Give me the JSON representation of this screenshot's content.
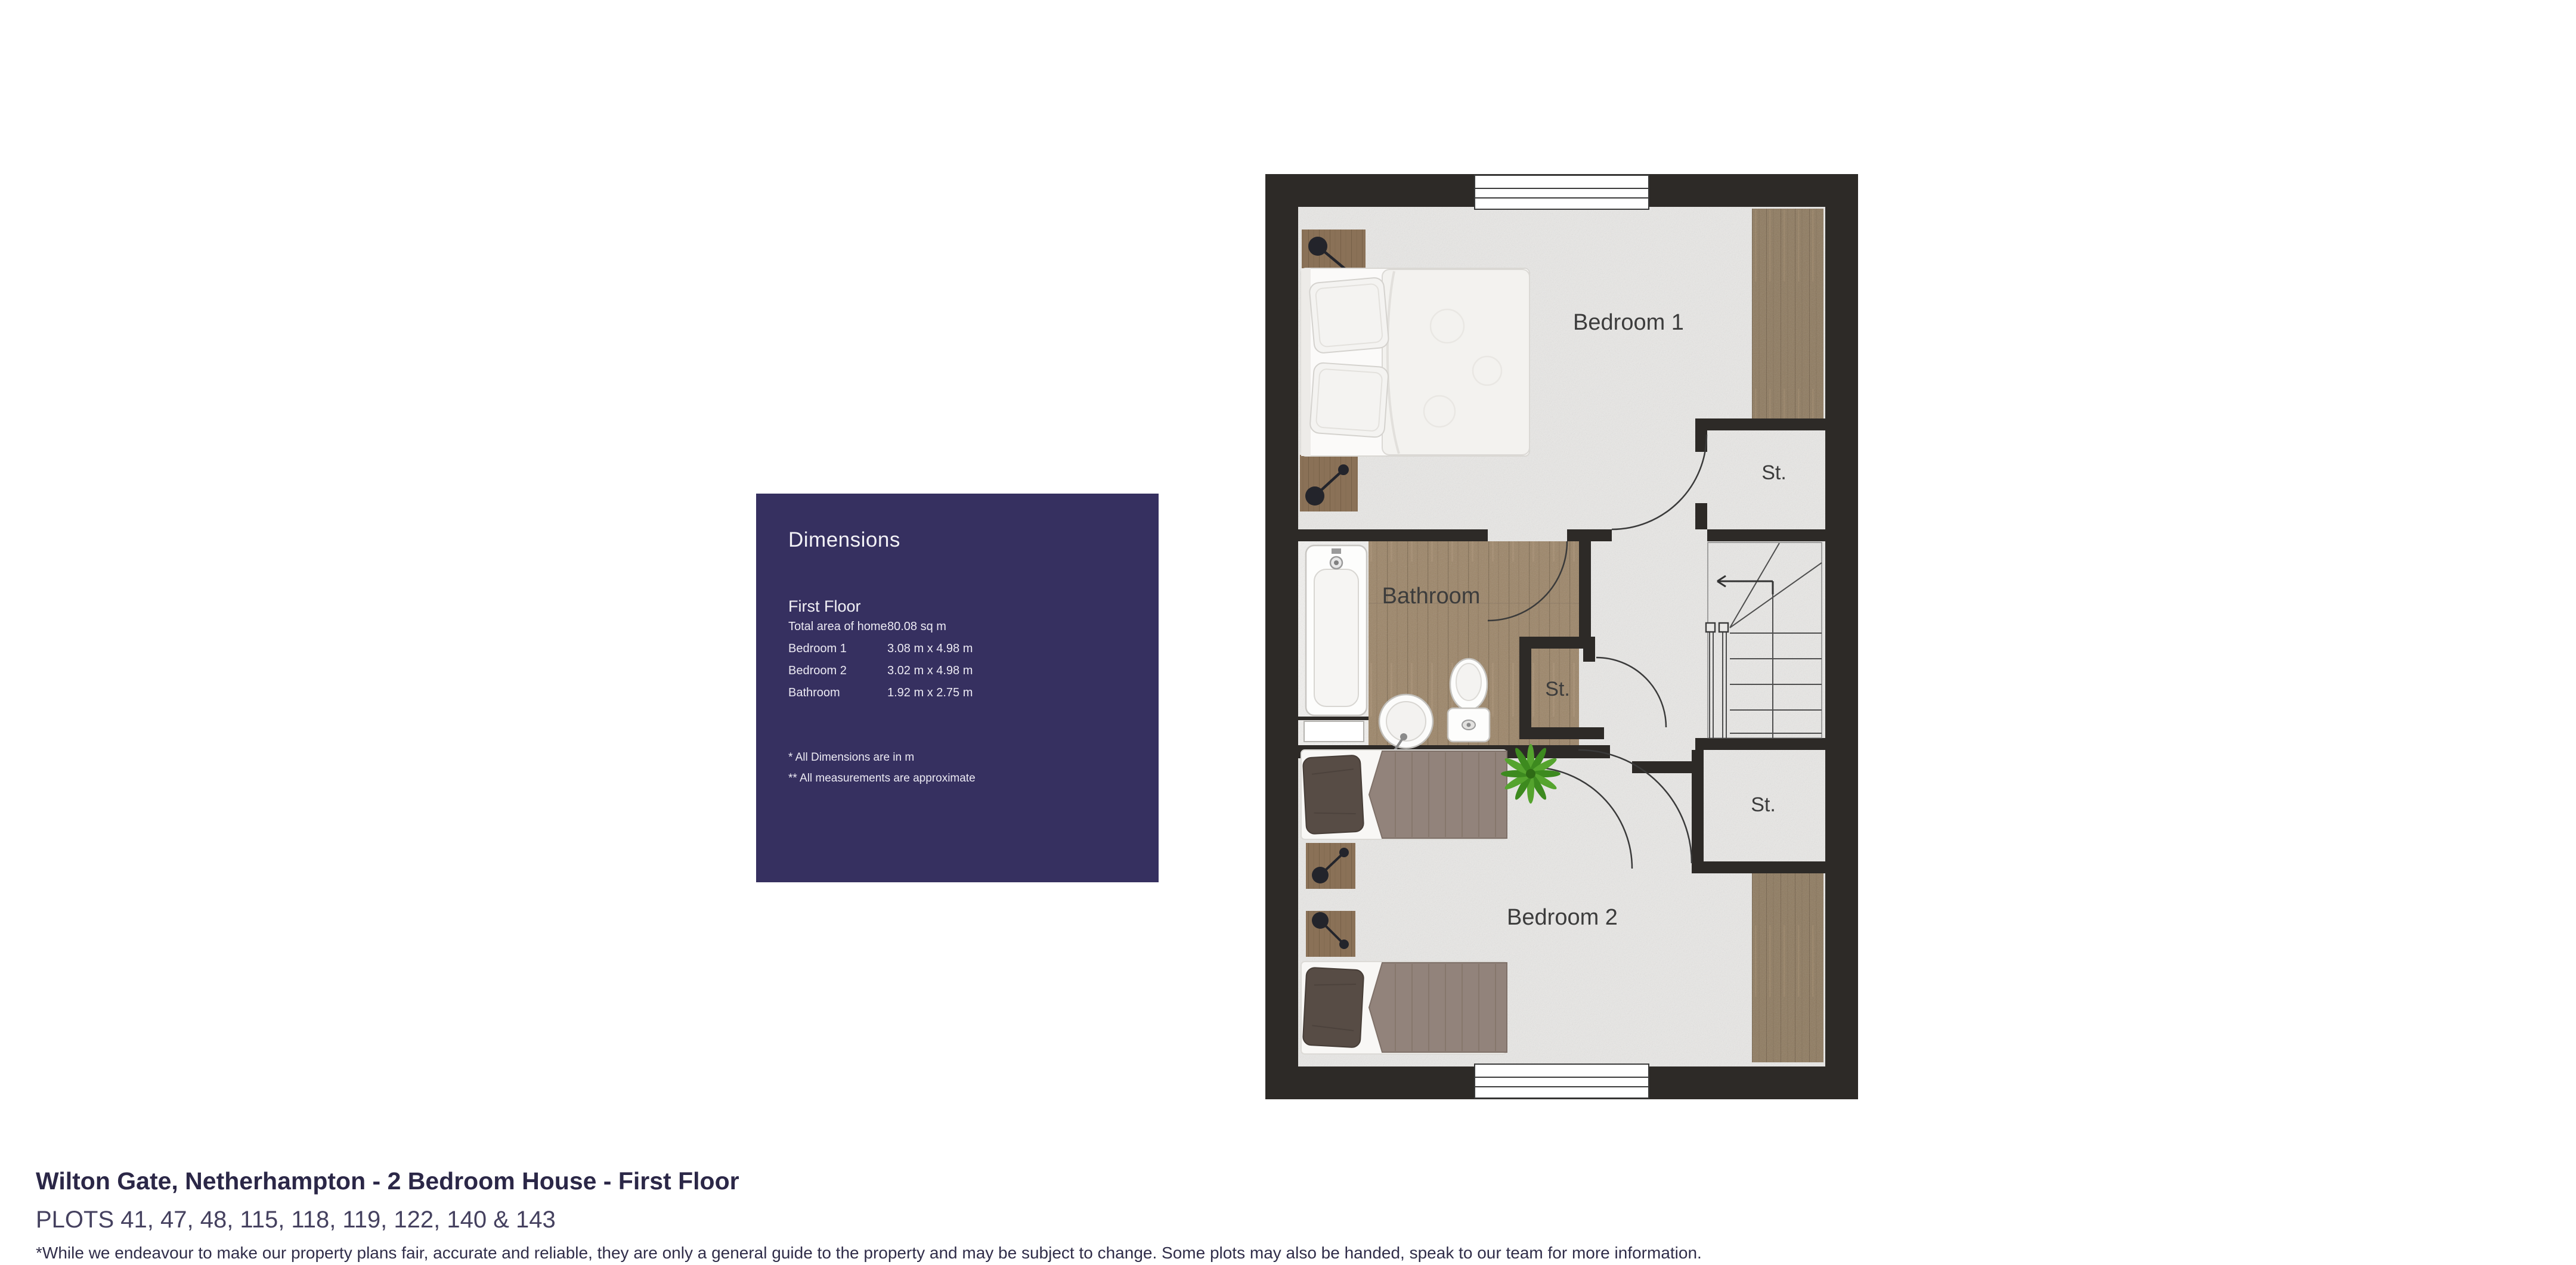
{
  "panel": {
    "title": "Dimensions",
    "section": "First Floor",
    "rows": [
      {
        "label": "Total area of home",
        "value": "80.08 sq m"
      },
      {
        "label": "Bedroom 1",
        "value": "3.08 m x 4.98 m"
      },
      {
        "label": "Bedroom 2",
        "value": "3.02 m x 4.98 m"
      },
      {
        "label": "Bathroom",
        "value": "1.92 m x 2.75 m"
      }
    ],
    "footnotes": [
      "* All Dimensions are in m",
      "** All measurements are approximate"
    ],
    "bg_color": "#363060"
  },
  "floorplan": {
    "rooms": {
      "bedroom1": "Bedroom 1",
      "bedroom2": "Bedroom 2",
      "bathroom": "Bathroom",
      "storage1": "St.",
      "storage2": "St.",
      "storage3": "St."
    },
    "wall_color": "#2d2a27",
    "floor_color": "#e9e8e6",
    "wood_floor_color": "#9c8568",
    "wardrobe_color": "#8e7a5f",
    "plant_color": "#55a42e"
  },
  "footer": {
    "title": "Wilton Gate, Netherhampton - 2 Bedroom House - First Floor",
    "plots": "PLOTS 41, 47, 48, 115, 118, 119, 122, 140 & 143",
    "disclaimer": "*While we endeavour to make our property plans fair, accurate and reliable, they are only a general guide to the property and may be subject to change. Some plots may also be handed, speak to our team for more information."
  }
}
